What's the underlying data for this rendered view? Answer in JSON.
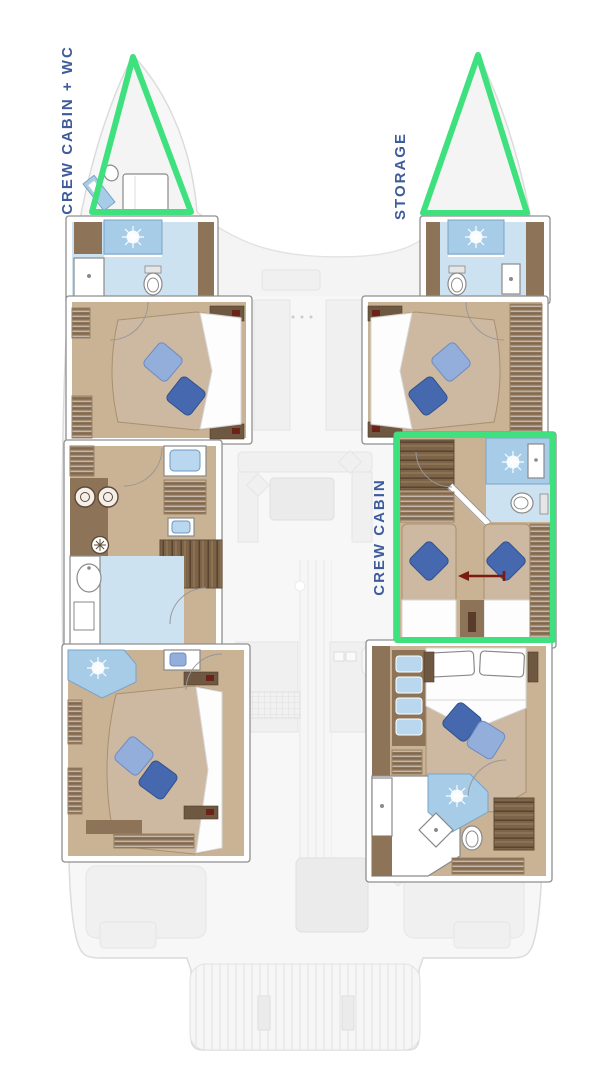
{
  "page": {
    "background": "#ffffff"
  },
  "plan": {
    "labels": {
      "bow_left": "CREW CABIN + WC",
      "bow_right": "STORAGE",
      "mid_right": "CREW CABIN"
    },
    "colors": {
      "highlight_green": "#3fe07e",
      "label_blue": "#3e5c9b",
      "bath_blue": "#cde2f1",
      "shower_blue": "#a6cce8",
      "pillow_dark": "#4568ae",
      "pillow_light": "#93aeda",
      "wood_floor": "#c9b394",
      "wood_mid": "#8d7458",
      "wood_dark": "#6e5842",
      "bed_tan": "#cdb9a2",
      "arrow_red": "#7b1a0e"
    }
  }
}
